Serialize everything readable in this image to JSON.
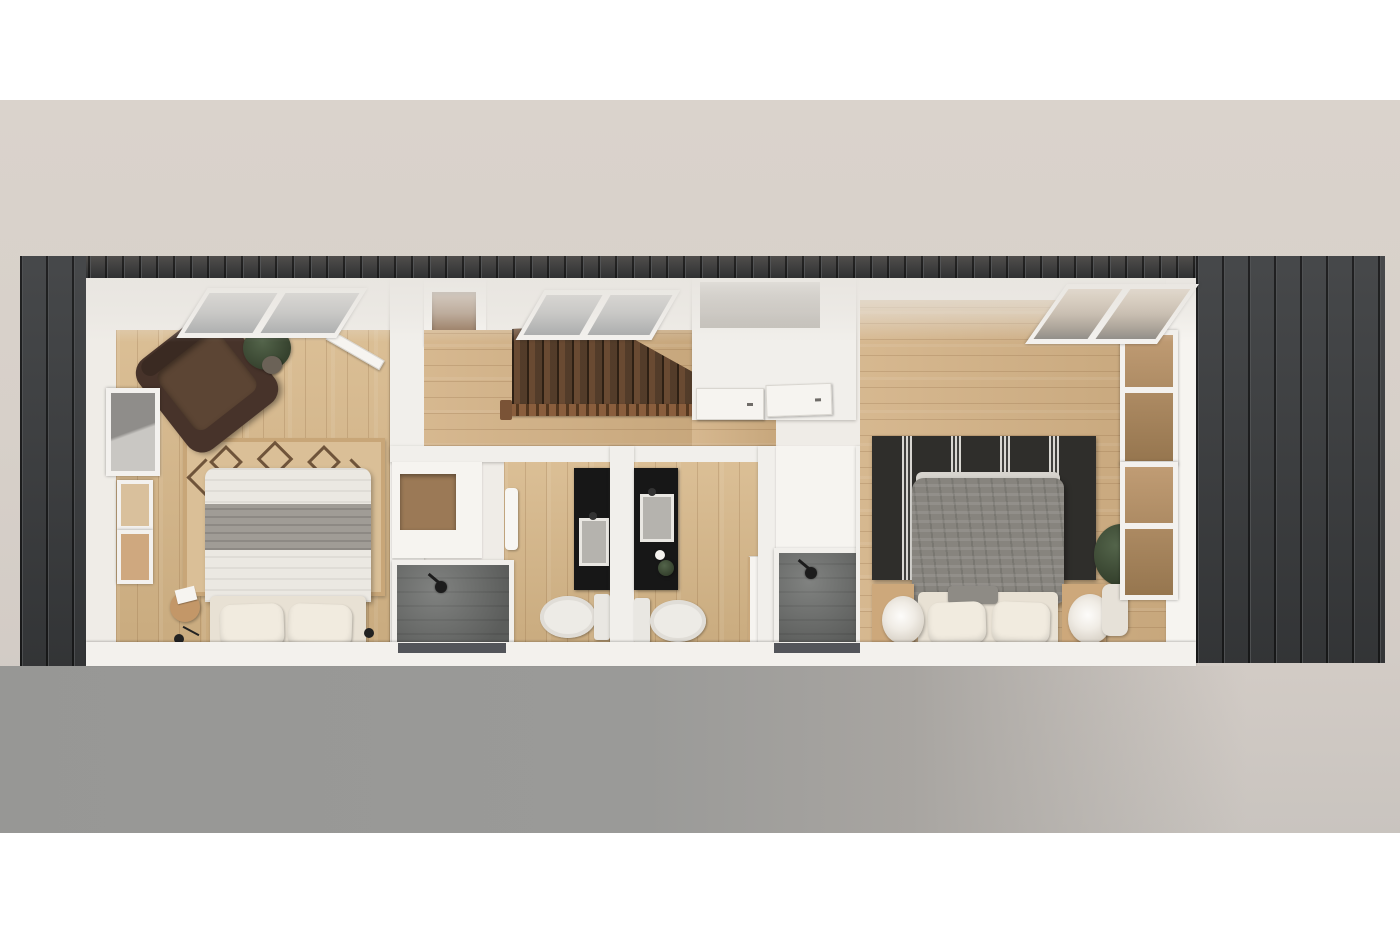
{
  "scene": {
    "title": "Top-down 3D cutaway rendering of a rectangular single-storey tiny home floor plan",
    "building": {
      "label": "Rectangular home with dark vertical-board siding, white interior walls and light oak plank floors, roof removed to reveal rooms",
      "siding_color": "#3a3c3e",
      "interior_wall_color": "#f1efeb",
      "floor_color": "#d3b285"
    },
    "backdrop": {
      "top_band": "#ffffff",
      "middle": "#d6cfc8",
      "bottom_band": "#ffffff",
      "ground_shadow": "#9a9a98"
    },
    "rooms": [
      {
        "id": "bedroom-left",
        "label": "Left bedroom: double bed with grey folded blanket and two pillows, tan kilim rug, brown leather armchair, potted plant, west-wall window, two picture frames, bedside stool with black reading lamp, open white door, north window",
        "items": [
          "double-bed",
          "kilim-rug",
          "leather-armchair",
          "potted-plant",
          "west-window",
          "picture-frames",
          "bedside-stool-lamp",
          "open-door",
          "north-window"
        ]
      },
      {
        "id": "hallway-landing",
        "label": "Hallway and stair landing: hardwood staircase with spindle railing descending, north window, storage closet",
        "items": [
          "staircase",
          "stair-railing",
          "north-window",
          "storage-closet"
        ]
      },
      {
        "id": "bathroom-1",
        "label": "Bathroom 1: walk-in shower with dark grey tile, black vanity with basin, toilet, towel rail, linen closet",
        "items": [
          "walk-in-shower",
          "black-vanity",
          "toilet",
          "towel-rail",
          "linen-closet"
        ]
      },
      {
        "id": "bathroom-2",
        "label": "Bathroom 2: black vanity with basin, toilet, toilet-paper roll, small plant, white door",
        "items": [
          "black-vanity",
          "toilet",
          "toilet-paper",
          "small-plant",
          "door"
        ]
      },
      {
        "id": "shower-room",
        "label": "Second walk-in shower room with grey tile and black rain shower head",
        "items": [
          "walk-in-shower"
        ]
      },
      {
        "id": "bedroom-right",
        "label": "Right bedroom: queen bed with rumpled grey duvet and cream pillows, black rug with white stripe clusters, two round bedside lamps, wardrobe with two white doors, fiddle-leaf plant with floor vase, tall east corner windows, north corner window",
        "items": [
          "queen-bed",
          "striped-rug",
          "round-lamps",
          "wardrobe-two-doors",
          "fiddle-leaf-plant",
          "east-windows",
          "north-corner-window"
        ]
      }
    ]
  },
  "palette": {
    "siding": "#3a3c3e",
    "interior_wall": "#f1efeb",
    "wood_floor": "#d3b285",
    "stairs_wood": "#5e432f",
    "shower_tile": "#6f716f",
    "vanity_black": "#171717",
    "rug_left_tan": "#dabf97",
    "rug_right_black": "#2f2e2b",
    "duvet_grey": "#87847e",
    "linen_cream": "#e8e1d4",
    "armchair_brown": "#47332a",
    "plant_green": "#3e4a36",
    "ground_shadow": "#9a9a98",
    "backdrop_beige": "#d6cfc8"
  }
}
